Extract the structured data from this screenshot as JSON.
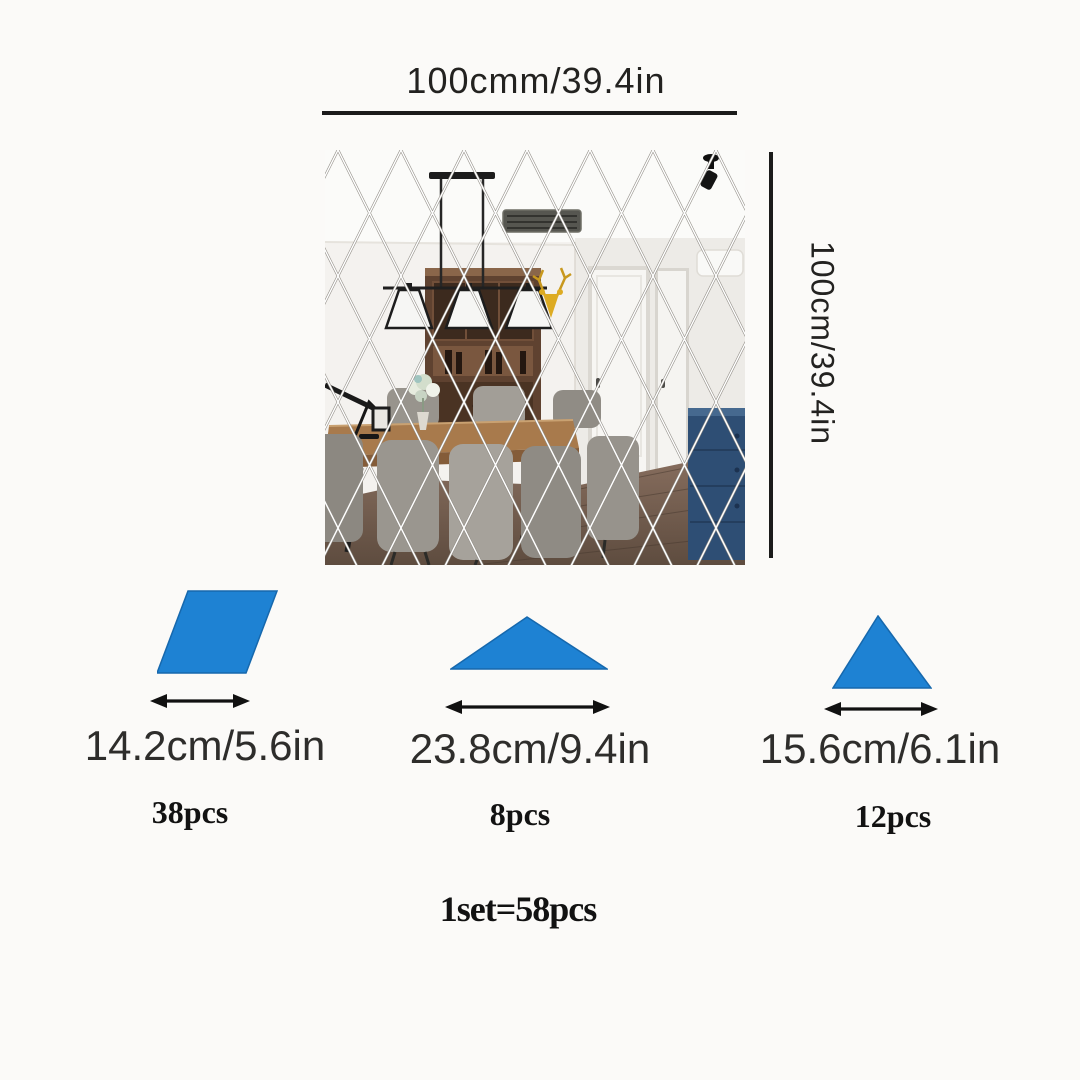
{
  "page": {
    "background": "#fbfaf8"
  },
  "wall": {
    "width_label": "100cmm/39.4in",
    "height_label": "100cm/39.4in"
  },
  "pieces": [
    {
      "shape": "rhombus",
      "size_label": "14.2cm/5.6in",
      "count_label": "38pcs",
      "fill": "#1e82d3"
    },
    {
      "shape": "wide-triangle",
      "size_label": "23.8cm/9.4in",
      "count_label": "8pcs",
      "fill": "#1e82d3"
    },
    {
      "shape": "tall-triangle",
      "size_label": "15.6cm/6.1in",
      "count_label": "12pcs",
      "fill": "#1e82d3"
    }
  ],
  "total_label": "1set=58pcs",
  "colors": {
    "dimension_line": "#1b1b1b",
    "size_text": "#2e2d2b",
    "count_text": "#121212",
    "accent_blue": "#1e82d3",
    "grid_line_dark": "#8f8b84",
    "grid_line_light": "#ffffff"
  }
}
